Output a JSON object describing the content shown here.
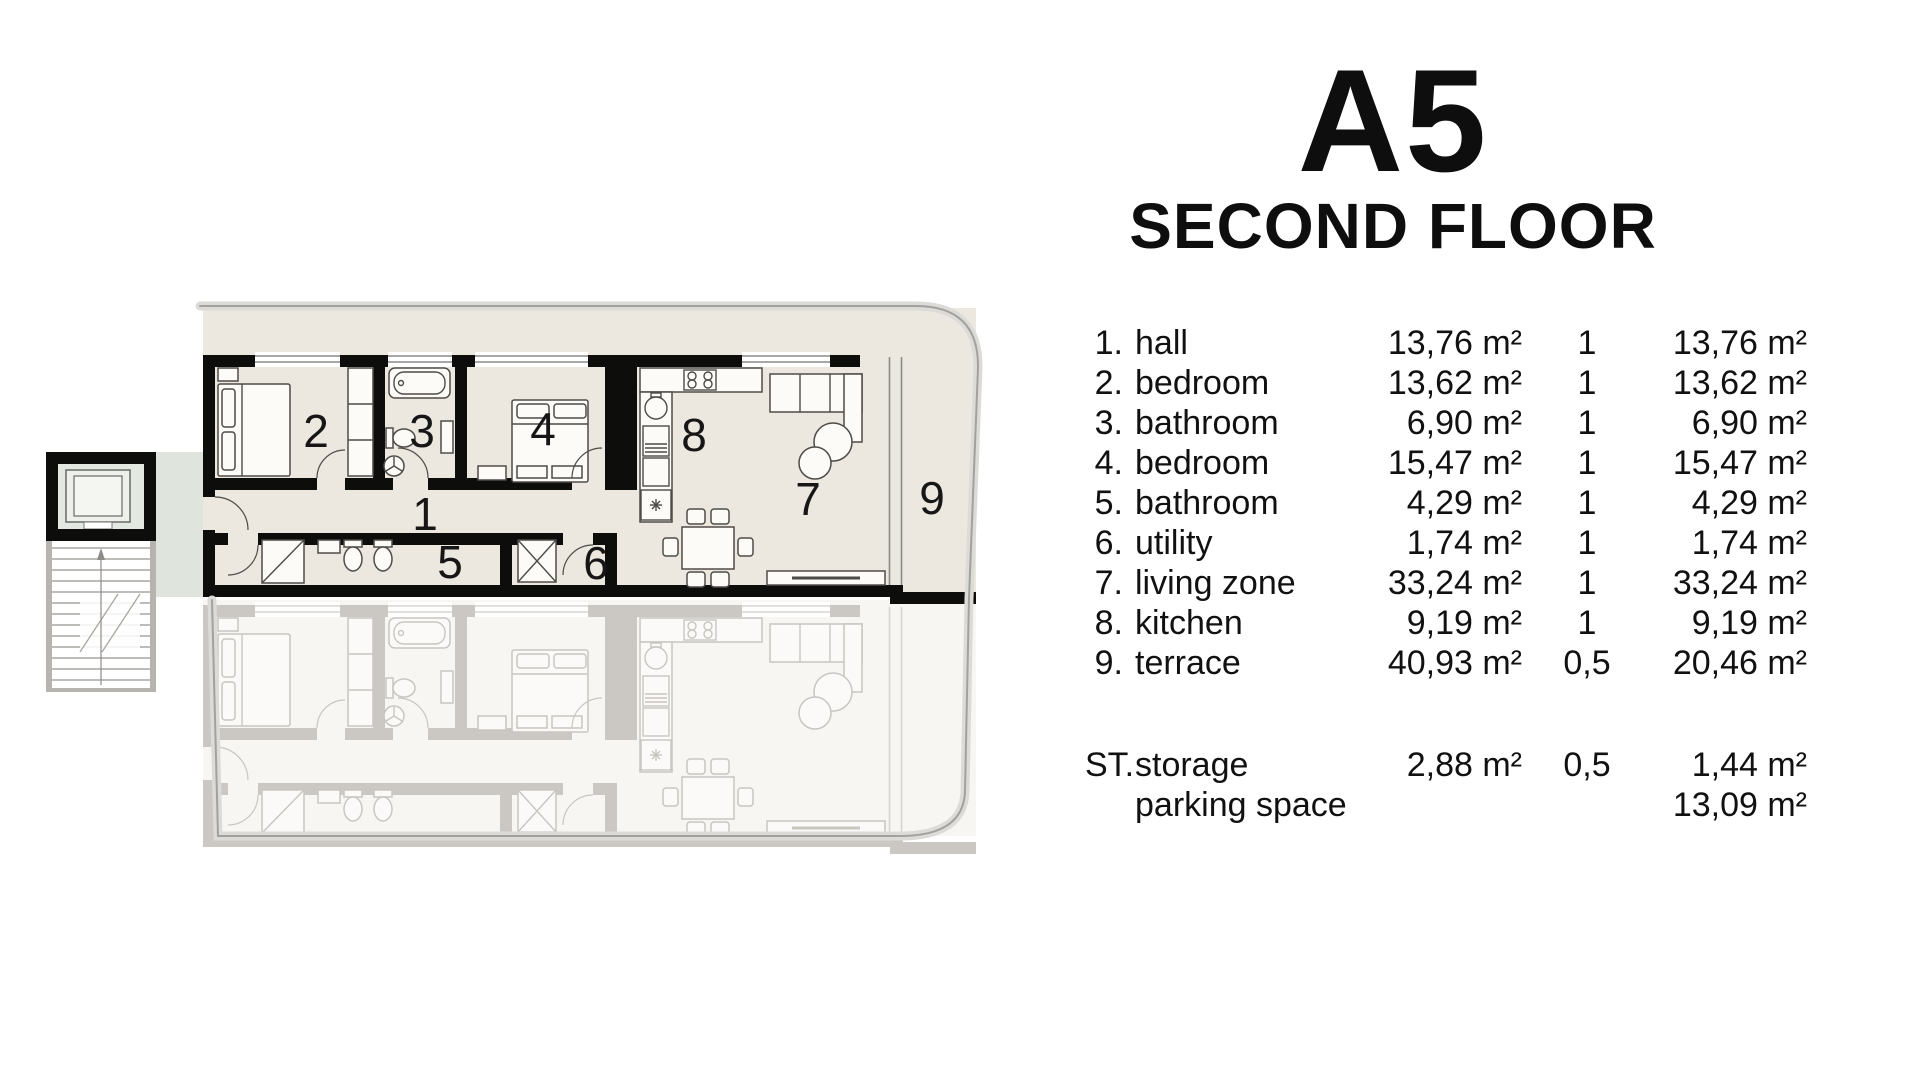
{
  "header": {
    "title": "A5",
    "subtitle": "SECOND FLOOR"
  },
  "legend": {
    "rows": [
      {
        "num": "1.",
        "name": "hall",
        "area": "13,76 m²",
        "factor": "1",
        "total": "13,76 m²"
      },
      {
        "num": "2.",
        "name": "bedroom",
        "area": "13,62 m²",
        "factor": "1",
        "total": "13,62 m²"
      },
      {
        "num": "3.",
        "name": "bathroom",
        "area": "6,90 m²",
        "factor": "1",
        "total": "6,90 m²"
      },
      {
        "num": "4.",
        "name": "bedroom",
        "area": "15,47 m²",
        "factor": "1",
        "total": "15,47 m²"
      },
      {
        "num": "5.",
        "name": "bathroom",
        "area": "4,29 m²",
        "factor": "1",
        "total": "4,29 m²"
      },
      {
        "num": "6.",
        "name": "utility",
        "area": "1,74 m²",
        "factor": "1",
        "total": "1,74 m²"
      },
      {
        "num": "7.",
        "name": "living zone",
        "area": "33,24 m²",
        "factor": "1",
        "total": "33,24 m²"
      },
      {
        "num": "8.",
        "name": "kitchen",
        "area": "9,19 m²",
        "factor": "1",
        "total": "9,19 m²"
      },
      {
        "num": "9.",
        "name": "terrace",
        "area": "40,93 m²",
        "factor": "0,5",
        "total": "20,46 m²"
      }
    ],
    "extra_rows": [
      {
        "num": "ST.",
        "name": "storage",
        "area": "2,88 m²",
        "factor": "0,5",
        "total": "1,44 m²"
      },
      {
        "num": "",
        "name": "parking space",
        "area": "",
        "factor": "",
        "total": "13,09 m²"
      }
    ]
  },
  "plan": {
    "room_labels": [
      "1",
      "2",
      "3",
      "4",
      "5",
      "6",
      "7",
      "8",
      "9"
    ],
    "colors": {
      "room_fill": "#ece7df",
      "core_fill": "#dfe5dc",
      "elevator_fill": "#e3e9e1",
      "wall": "#0d0d0c",
      "outline": "#a2a19e",
      "ghost_floor_fill": "#f7f6f3"
    }
  }
}
